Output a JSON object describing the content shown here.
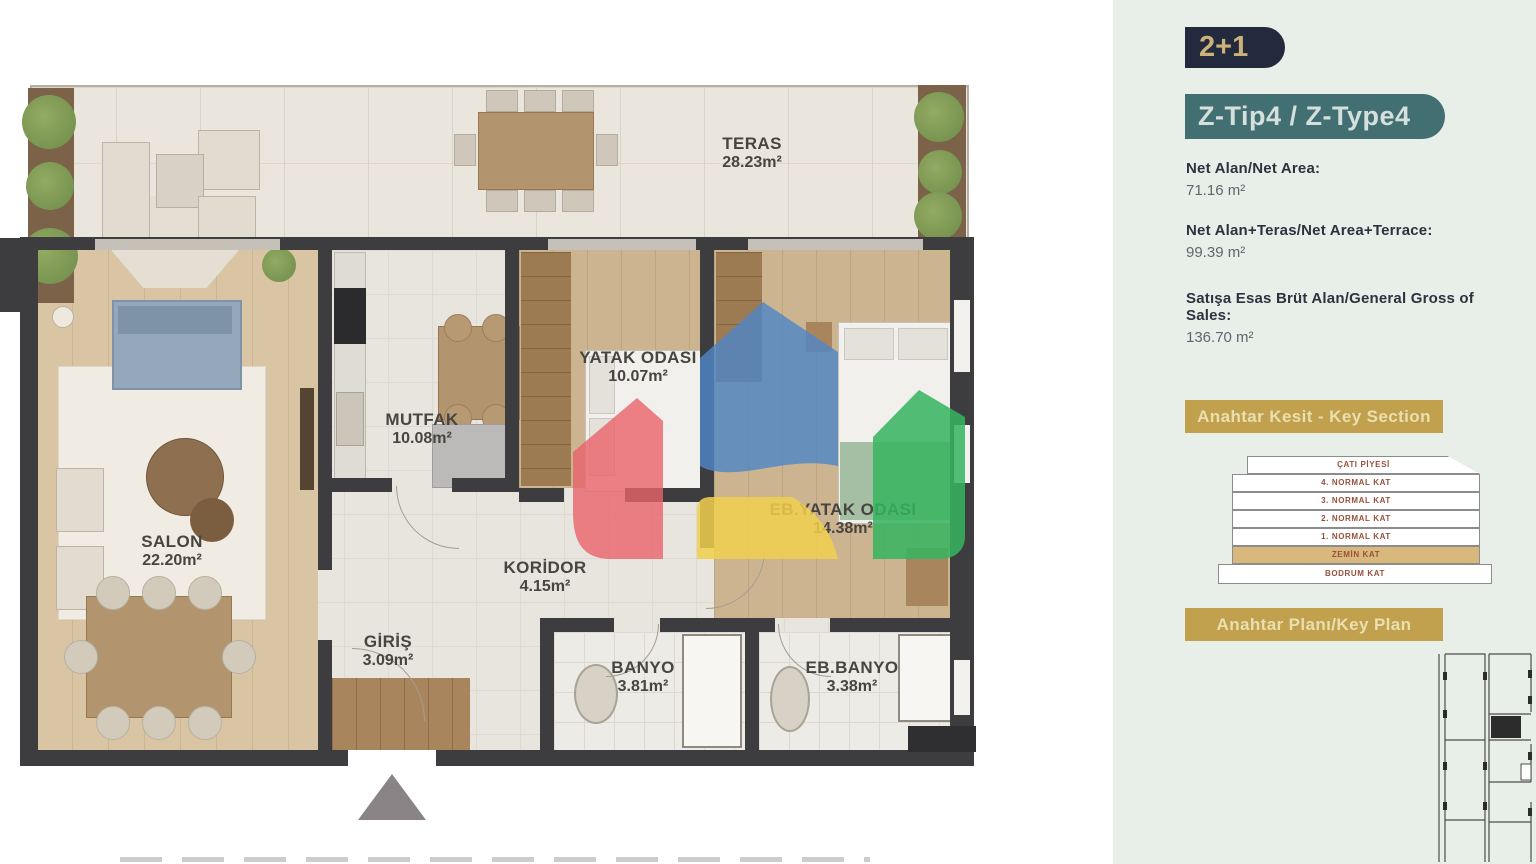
{
  "floor_plan": {
    "rooms": [
      {
        "name": "TERAS",
        "area": "28.23m²"
      },
      {
        "name": "SALON",
        "area": "22.20m²"
      },
      {
        "name": "MUTFAK",
        "area": "10.08m²"
      },
      {
        "name": "KORİDOR",
        "area": "4.15m²"
      },
      {
        "name": "GİRİŞ",
        "area": "3.09m²"
      },
      {
        "name": "BANYO",
        "area": "3.81m²"
      },
      {
        "name": "EB.BANYO",
        "area": "3.38m²"
      },
      {
        "name": "YATAK ODASI",
        "area": "10.07m²"
      },
      {
        "name": "EB.YATAK ODASI",
        "area": "14.38m²"
      }
    ]
  },
  "sidebar": {
    "unit_type": "2+1",
    "unit_code": "Z-Tip4 / Z-Type4",
    "stats": [
      {
        "label": "Net Alan/Net Area:",
        "value": "71.16 m²"
      },
      {
        "label": "Net Alan+Teras/Net Area+Terrace:",
        "value": "99.39 m²"
      },
      {
        "label": "Satışa Esas Brüt Alan/General Gross of Sales:",
        "value": "136.70 m²"
      }
    ],
    "key_section": {
      "title": "Anahtar Kesit - Key Section",
      "floors": [
        {
          "label": "ÇATI PİYESİ"
        },
        {
          "label": "4. NORMAL KAT"
        },
        {
          "label": "3. NORMAL KAT"
        },
        {
          "label": "2. NORMAL KAT"
        },
        {
          "label": "1. NORMAL KAT"
        },
        {
          "label": "ZEMİN KAT",
          "highlighted": true
        },
        {
          "label": "BODRUM KAT"
        }
      ]
    },
    "key_plan": {
      "title": "Anahtar Planı/Key Plan"
    }
  },
  "colors": {
    "badge_navy": "#232a3e",
    "badge_text_gold": "#ccb27a",
    "badge_teal": "#426f72",
    "banner_gold": "#c1a14e",
    "wall": "#3d3d40",
    "sidebar_bg": "#e8efe9",
    "watermark_red": "#e8636a",
    "watermark_blue": "#4f86c6",
    "watermark_yellow": "#f0d04e",
    "watermark_green": "#35b45f"
  }
}
